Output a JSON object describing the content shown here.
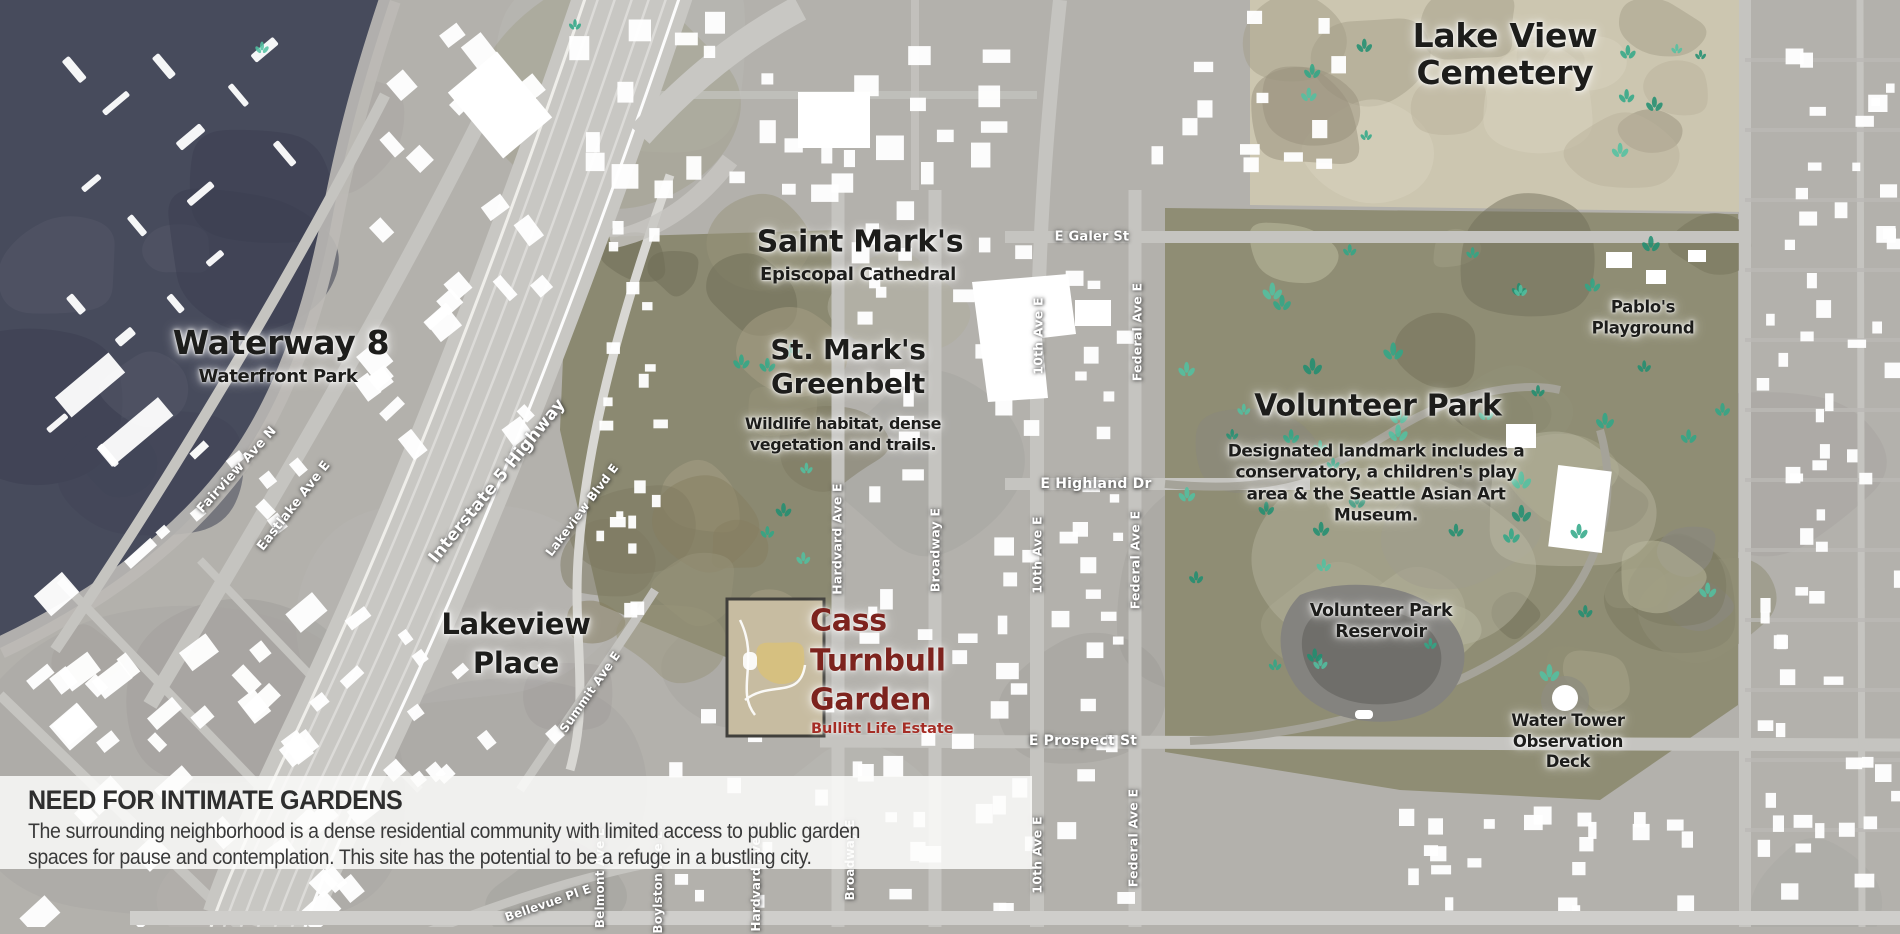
{
  "panel": {
    "title": "NEED FOR INTIMATE GARDENS",
    "body_lines": [
      "The surrounding neighborhood is a dense residential community with limited access to public garden",
      "spaces for pause and contemplation. This site has the potential to be a refuge in a bustling city."
    ]
  },
  "site": {
    "name": "Cass Turnbull Garden",
    "subtitle": "Bullitt Life Estate"
  },
  "colors": {
    "site_red": "#7d231e",
    "site_red_light": "#a52d25",
    "label_dark": "#1d1d1b",
    "street_label_white": "#ffffff",
    "water": "#474b5c",
    "park_olive": "#8f8d74",
    "cemetery_beige": "#ccc6b0",
    "panel_bg": "rgba(253,253,252,0.84)"
  },
  "labels": [
    {
      "name": "label-lake-view-cemetery",
      "kind": "place",
      "lines": [
        "Lake View",
        "Cemetery"
      ],
      "x": 1505,
      "y": 55,
      "size": 33,
      "lh": 1.12
    },
    {
      "name": "label-waterway-8",
      "kind": "place",
      "lines": [
        "Waterway 8"
      ],
      "x": 281,
      "y": 343,
      "size": 33
    },
    {
      "name": "label-waterfront-park",
      "kind": "place",
      "lines": [
        "Waterfront Park"
      ],
      "x": 278,
      "y": 377,
      "size": 18
    },
    {
      "name": "label-saint-marks",
      "kind": "place",
      "lines": [
        "Saint Mark's"
      ],
      "x": 860,
      "y": 242,
      "size": 30
    },
    {
      "name": "label-episcopal-cathedral",
      "kind": "place",
      "lines": [
        "Episcopal Cathedral"
      ],
      "x": 858,
      "y": 275,
      "size": 18
    },
    {
      "name": "label-st-marks-greenbelt",
      "kind": "place",
      "lines": [
        "St. Mark's",
        "Greenbelt"
      ],
      "x": 848,
      "y": 367,
      "size": 28,
      "lh": 1.22
    },
    {
      "name": "label-greenbelt-desc",
      "kind": "place-desc",
      "lines": [
        "Wildlife habitat, dense",
        "vegetation and trails."
      ],
      "x": 843,
      "y": 435,
      "size": 16,
      "lh": 1.3
    },
    {
      "name": "label-volunteer-park",
      "kind": "place",
      "lines": [
        "Volunteer Park"
      ],
      "x": 1378,
      "y": 406,
      "size": 30
    },
    {
      "name": "label-volunteer-park-desc",
      "kind": "place-desc",
      "lines": [
        "Designated landmark includes a",
        "conservatory, a children's play",
        "area & the Seattle Asian Art",
        "Museum."
      ],
      "x": 1376,
      "y": 484,
      "size": 17,
      "lh": 1.25
    },
    {
      "name": "label-lakeview-place",
      "kind": "place",
      "lines": [
        "Lakeview",
        "Place"
      ],
      "x": 516,
      "y": 644,
      "size": 29,
      "lh": 1.35
    },
    {
      "name": "label-pablos-playground",
      "kind": "place",
      "lines": [
        "Pablo's",
        "Playground"
      ],
      "x": 1643,
      "y": 318,
      "size": 16.5,
      "lh": 1.3
    },
    {
      "name": "label-volunteer-park-reservoir",
      "kind": "place",
      "lines": [
        "Volunteer Park",
        "Reservoir"
      ],
      "x": 1381,
      "y": 622,
      "size": 17.5,
      "lh": 1.2
    },
    {
      "name": "label-water-tower",
      "kind": "place",
      "lines": [
        "Water Tower",
        "Observation",
        "Deck"
      ],
      "x": 1568,
      "y": 742,
      "size": 16.5,
      "lh": 1.25
    },
    {
      "name": "label-cass-turnbull-garden",
      "kind": "site",
      "lines": [
        "Cass",
        "Turnbull",
        "Garden"
      ],
      "x": 810,
      "y": 661,
      "size": 30,
      "lh": 1.32,
      "align": "left"
    },
    {
      "name": "label-bullitt-life-estate",
      "kind": "site-sub",
      "lines": [
        "Bullitt Life Estate"
      ],
      "x": 811,
      "y": 729,
      "size": 14.5,
      "align": "left"
    },
    {
      "name": "street-fairview-ave-n",
      "kind": "street",
      "lines": [
        "Fairview Ave N"
      ],
      "x": 237,
      "y": 470,
      "size": 13,
      "rotate": -48
    },
    {
      "name": "street-eastlake-ave-e",
      "kind": "street",
      "lines": [
        "Eastlake Ave E"
      ],
      "x": 294,
      "y": 506,
      "size": 13,
      "rotate": -52
    },
    {
      "name": "street-interstate-5-highway",
      "kind": "street",
      "lines": [
        "Interstate 5 Highway"
      ],
      "x": 497,
      "y": 481,
      "size": 17,
      "rotate": -51
    },
    {
      "name": "street-lakeview-blvd-e",
      "kind": "street",
      "lines": [
        "Lakeview Blvd E"
      ],
      "x": 582,
      "y": 510,
      "size": 12,
      "rotate": -53
    },
    {
      "name": "street-summit-ave-e",
      "kind": "street",
      "lines": [
        "Summit Ave E"
      ],
      "x": 590,
      "y": 692,
      "size": 12,
      "rotate": -55
    },
    {
      "name": "street-bellevue-pl-e",
      "kind": "street",
      "lines": [
        "Bellevue Pl E"
      ],
      "x": 548,
      "y": 903,
      "size": 12,
      "rotate": -19
    },
    {
      "name": "street-e-galer-st",
      "kind": "street",
      "lines": [
        "E Galer St"
      ],
      "x": 1092,
      "y": 237,
      "size": 13
    },
    {
      "name": "street-e-highland-dr",
      "kind": "street",
      "lines": [
        "E Highland Dr"
      ],
      "x": 1096,
      "y": 484,
      "size": 14
    },
    {
      "name": "street-e-prospect-st",
      "kind": "street",
      "lines": [
        "E Prospect St"
      ],
      "x": 1083,
      "y": 741,
      "size": 14
    },
    {
      "name": "street-hardvard-ave-e-north",
      "kind": "street",
      "lines": [
        "Hardvard Ave E"
      ],
      "x": 837,
      "y": 539,
      "size": 12.5,
      "rotate": -90
    },
    {
      "name": "street-broadway-e-north",
      "kind": "street",
      "lines": [
        "Broadway E"
      ],
      "x": 935,
      "y": 550,
      "size": 12.5,
      "rotate": -90
    },
    {
      "name": "street-10th-ave-e-north",
      "kind": "street",
      "lines": [
        "10th Ave E"
      ],
      "x": 1038,
      "y": 336,
      "size": 12.5,
      "rotate": -90
    },
    {
      "name": "street-federal-ave-e-north",
      "kind": "street",
      "lines": [
        "Federal Ave E"
      ],
      "x": 1137,
      "y": 332,
      "size": 12.5,
      "rotate": -90
    },
    {
      "name": "street-10th-ave-e-mid",
      "kind": "street",
      "lines": [
        "10th Ave E"
      ],
      "x": 1037,
      "y": 555,
      "size": 12.5,
      "rotate": -90
    },
    {
      "name": "street-federal-ave-e-mid",
      "kind": "street",
      "lines": [
        "Federal Ave E"
      ],
      "x": 1135,
      "y": 560,
      "size": 12.5,
      "rotate": -90
    },
    {
      "name": "street-10th-ave-e-south",
      "kind": "street",
      "lines": [
        "10th Ave E"
      ],
      "x": 1037,
      "y": 855,
      "size": 12.5,
      "rotate": -90
    },
    {
      "name": "street-federal-ave-e-south",
      "kind": "street",
      "lines": [
        "Federal Ave E"
      ],
      "x": 1133,
      "y": 838,
      "size": 12.5,
      "rotate": -90
    },
    {
      "name": "street-belmont-ave-e",
      "kind": "street",
      "lines": [
        "Belmont Ave E"
      ],
      "x": 600,
      "y": 878,
      "size": 12,
      "rotate": -90
    },
    {
      "name": "street-boylston-ave-e",
      "kind": "street",
      "lines": [
        "Boylston Ave E"
      ],
      "x": 658,
      "y": 882,
      "size": 12,
      "rotate": -90
    },
    {
      "name": "street-hardvard-ave-e-south",
      "kind": "street",
      "lines": [
        "Hardvard Ave E"
      ],
      "x": 756,
      "y": 878,
      "size": 12,
      "rotate": -90
    },
    {
      "name": "street-broadway-e-south",
      "kind": "street",
      "lines": [
        "Broadway E"
      ],
      "x": 850,
      "y": 860,
      "size": 12,
      "rotate": -90
    }
  ]
}
